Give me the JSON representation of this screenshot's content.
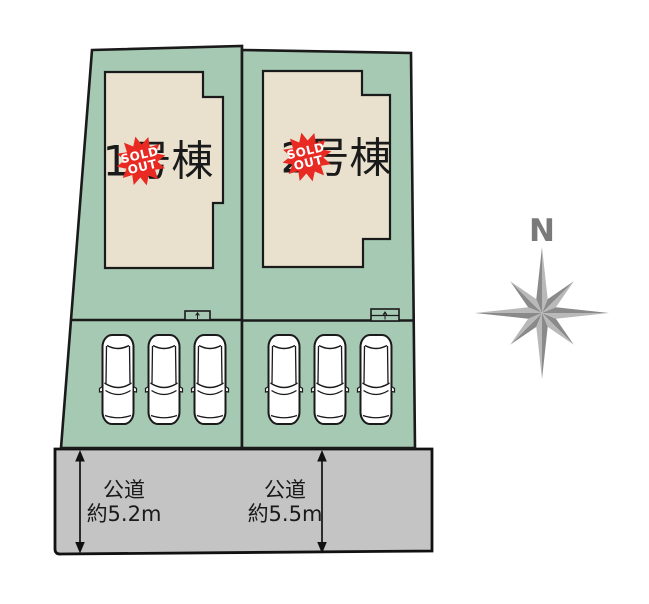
{
  "lots": [
    {
      "label": "1号棟",
      "badge": {
        "line1": "SOLD",
        "line2": "OUT"
      }
    },
    {
      "label": "2号棟",
      "badge": {
        "line1": "SOLD",
        "line2": "OUT"
      }
    }
  ],
  "roads": [
    {
      "type": "公道",
      "width": "約5.2m"
    },
    {
      "type": "公道",
      "width": "約5.5m"
    }
  ],
  "compass": {
    "north": "N"
  },
  "colors": {
    "lot_fill": "#a6c9b3",
    "building_fill": "#e9e1ce",
    "road_fill": "#c4c4c4",
    "badge_red": "#e82a22",
    "compass_dark": "#8a8a8a",
    "compass_light": "#b9b9b9",
    "outline": "#1a1a1a"
  }
}
